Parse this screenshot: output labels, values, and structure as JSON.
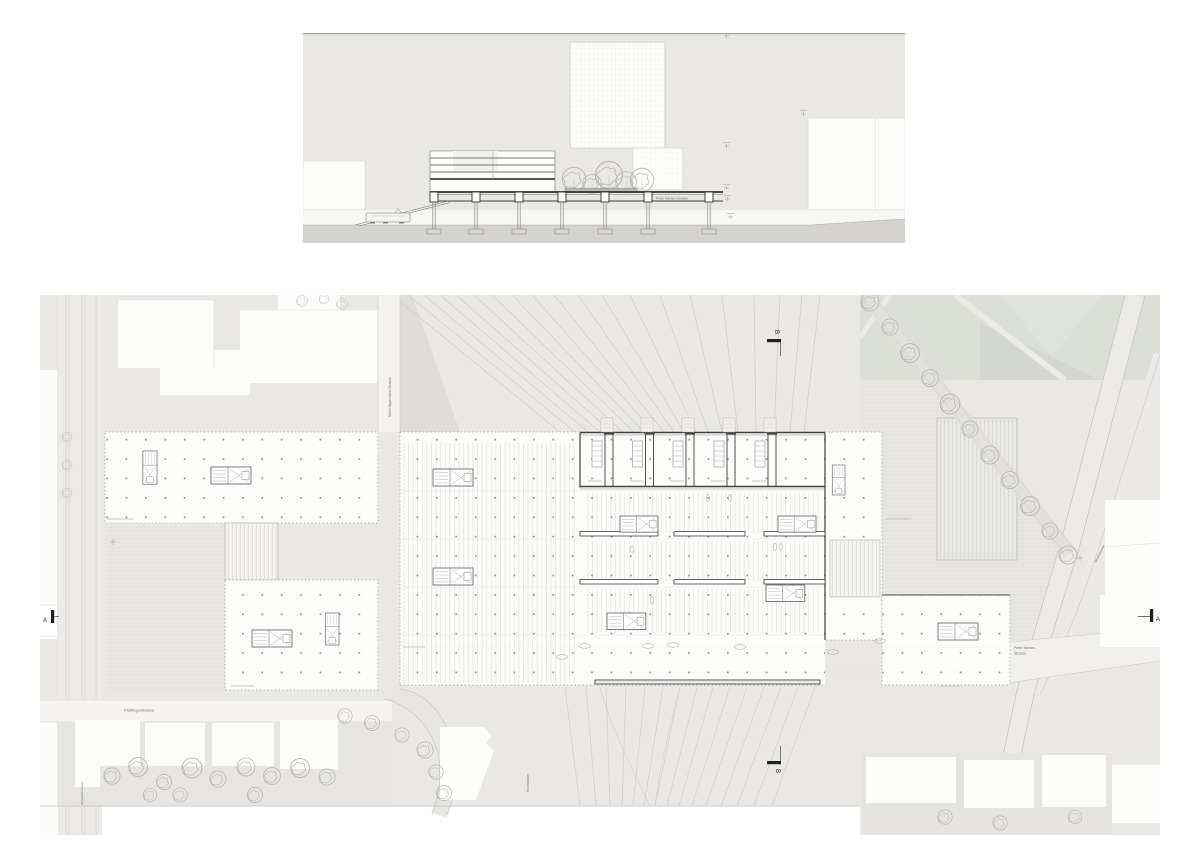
{
  "labels": {
    "peter_merian_section": "Peter Merian-Strasse",
    "pfeffingerstrasse": "Pfeffingerstrasse",
    "meret_oppenheim": "Meret Oppenheim-Strasse",
    "hochstrasse": "Hochstrasse",
    "nauenstrasse": "Nauenstrasse",
    "margarethenstrasse": "Margarethenstrasse",
    "peter_merian_1": "Peter Merian-",
    "peter_merian_2": "Strasse",
    "marker_a": "A",
    "marker_b": "B"
  },
  "colors": {
    "page_bg": "#ffffff",
    "panel_bg": "#e9e8e5",
    "ground": "#d4d3d0",
    "park": "#dcded8",
    "plaza": "#e7e6e3",
    "line_dark": "#3f3f3d",
    "line_light": "#cfcecb",
    "tree": "#b3b3b0",
    "building_white": "#fcfcfb"
  }
}
